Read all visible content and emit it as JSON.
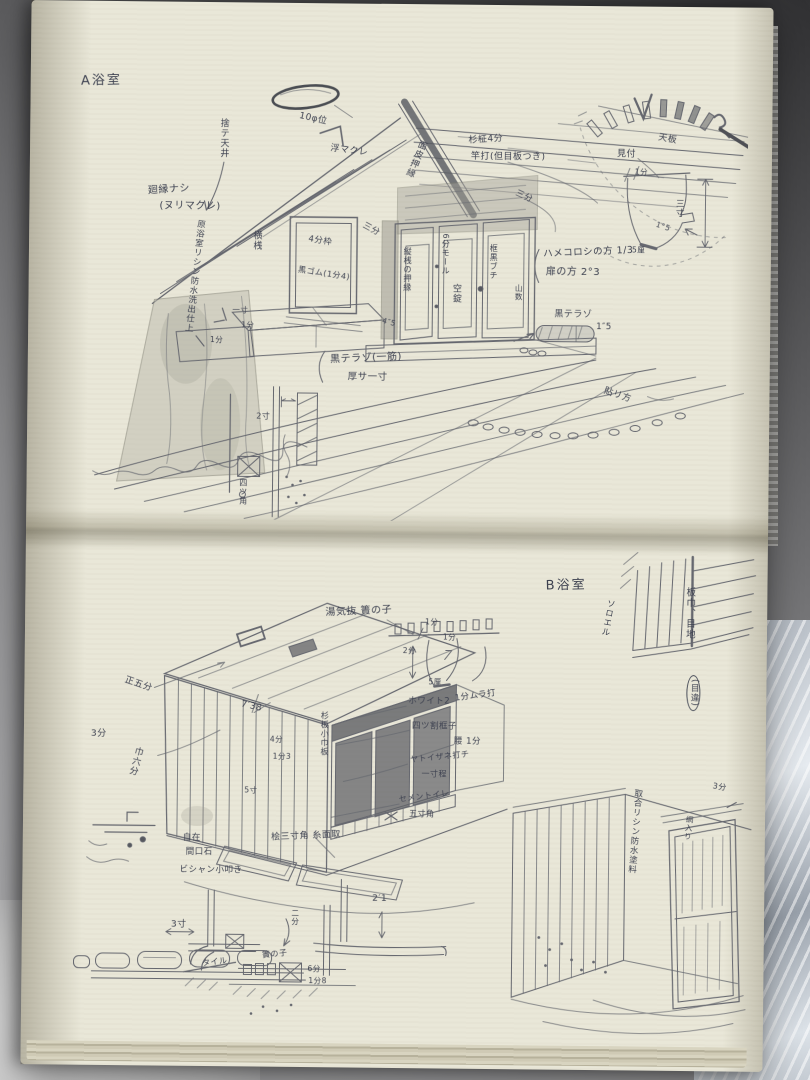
{
  "page_a": {
    "title": "A浴室",
    "annotations": {
      "vent_dia": "10φ位",
      "ukimakure": "浮マクレ",
      "sute_tenjo": "捨テ天井",
      "mawaribuchi_1": "廻縁ナシ",
      "mawaribuchi_2": "(ヌリマクレ)",
      "wall_finish": "原浴室リシン防水洗出仕上",
      "yokozan": "横桟",
      "window_frame": "4分枠",
      "kuro_gomu": "黒ゴム(1分4)",
      "ceiling_1": "杉柾4分",
      "ceiling_2": "竿打(但目板つき)",
      "sanbu_left": "三分",
      "sanbu_right": "三分",
      "beam_note": "面皮押縁",
      "door_left": "縦桟の押縁",
      "door_mid_top": "6分モール",
      "door_mid": "空錠",
      "door_right": "框黒ブチ",
      "door_right_sub": "山数",
      "hamekoroshi": "ハメコロシの方 1/3",
      "tobira": "扉の方 2°3",
      "terazo_side": "黒テラゾ",
      "terazo_side_dim": "1″5",
      "terazo_floor_1": "黒テラゾ(一筋)",
      "terazo_floor_2": "厚サ一寸",
      "harikata": "貼リ方",
      "step_issun": "一寸",
      "step_ichibu_a": "1分",
      "step_ichibu_b": "1分",
      "dim_4_5": "4″5",
      "section_dim": "2寸",
      "yotsukado": "四ツ角",
      "tenban": "天板",
      "mitsuke": "見付",
      "funnel_top": "1分",
      "funnel_right": "三寸",
      "funnel_step": "1°5",
      "funnel_bottom": "5厘"
    }
  },
  "page_b": {
    "title": "B浴室",
    "annotations": {
      "soroeru": "ソロエル",
      "itahaba": "板巾、目地",
      "mechigai": "(目違)",
      "yugenuki": "湯気抜 簀の子",
      "slat_left": "2分",
      "slat_top": "1分",
      "slat_right": "1分",
      "slat_bottom": "5厘",
      "white_2": "ホワイト2",
      "mura_uchi": "1分ムラ打",
      "yotsuwari": "四ツ割框子",
      "koshi": "腰 1分",
      "yatoizane_1": "ヤトイザネ打チ",
      "yatoizane_2": "一寸程",
      "cement_1": "セメントイレ",
      "cement_2": "五寸角",
      "hinoki": "桧三寸角 糸面取",
      "sho_gobu": "正五分",
      "sanbu": "3分",
      "haba_rokubu": "巾六分",
      "dim_738": "7′38",
      "sugi_ita": "杉板小巾板",
      "dim_4bu": "4分",
      "dim_1_3": "1分3",
      "dim_5sun": "5寸",
      "toriai": "取合リシン防水塗料",
      "ami_iri": "網入り",
      "dim_3bu": "3分",
      "jizai_1": "自在",
      "jizai_2": "間口石",
      "jizai_3": "ビシャン小叩き",
      "dim_3sun": "3寸",
      "dim_nibu": "二分",
      "dim_2_1": "2′1",
      "tile": "タイル",
      "sunoko": "簀の子",
      "dim_6bu": "6分",
      "dim_1_8": "1分8"
    }
  }
}
